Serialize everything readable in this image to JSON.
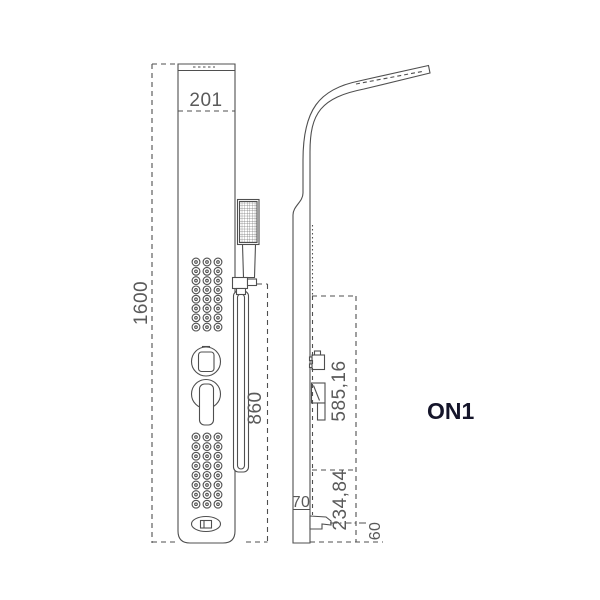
{
  "drawing": {
    "title": "shower panel technical drawing",
    "model_label": "ON1",
    "labels": {
      "panel_width": "201",
      "panel_height": "1600",
      "rail_length": "860",
      "upper_section": "585,16",
      "lower_section": "234,84",
      "panel_depth": "70",
      "spout_offset": "60"
    },
    "front_view": {
      "jet_grids": [
        {
          "rows": 8,
          "cols": 3
        },
        {
          "rows": 8,
          "cols": 3
        }
      ]
    },
    "colors": {
      "line": "#4f4f4f",
      "dim_text": "#5a5a5a",
      "model_text": "#15152a",
      "background": "#ffffff"
    }
  }
}
